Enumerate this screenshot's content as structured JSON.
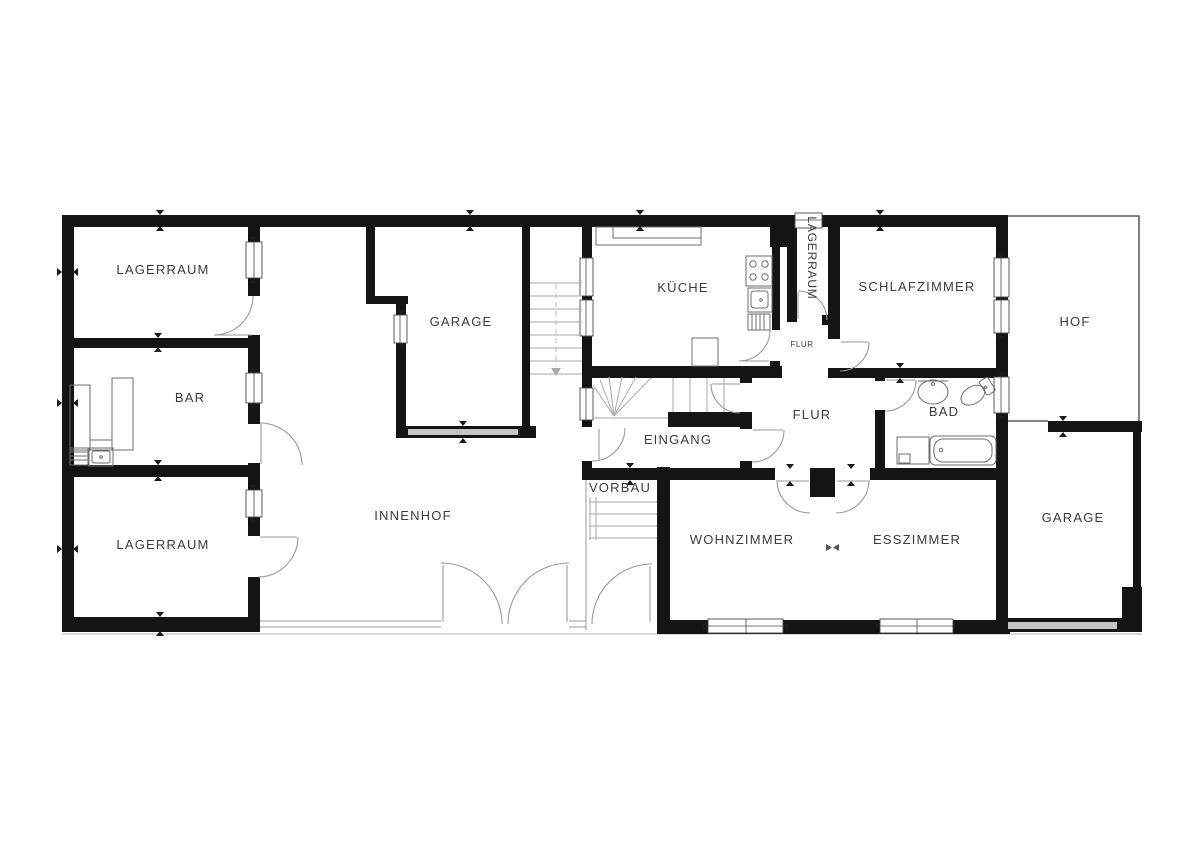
{
  "rooms": {
    "lagerraum_top": {
      "label": "LAGERRAUM"
    },
    "bar": {
      "label": "BAR"
    },
    "lagerraum_bottom": {
      "label": "LAGERRAUM"
    },
    "innenhof": {
      "label": "INNENHOF"
    },
    "garage_top": {
      "label": "GARAGE"
    },
    "kueche": {
      "label": "KÜCHE"
    },
    "lagerraum_side": {
      "label": "LAGERRAUM"
    },
    "schlafzimmer": {
      "label": "SCHLAFZIMMER"
    },
    "hof": {
      "label": "HOF"
    },
    "flur_small": {
      "label": "FLUR"
    },
    "flur": {
      "label": "FLUR"
    },
    "bad": {
      "label": "BAD"
    },
    "eingang": {
      "label": "EINGANG"
    },
    "vorbau": {
      "label": "VORBAU"
    },
    "wohnzimmer": {
      "label": "WOHNZIMMER"
    },
    "esszimmer": {
      "label": "ESSZIMMER"
    },
    "garage_bottom": {
      "label": "GARAGE"
    }
  },
  "colors": {
    "wall": "#141414",
    "label": "#3c3c3c",
    "door": "#9a9a9a",
    "stair": "#aaaaaa",
    "garage_door": "#c4c4c4",
    "window_frame": "#4a4a4a"
  }
}
